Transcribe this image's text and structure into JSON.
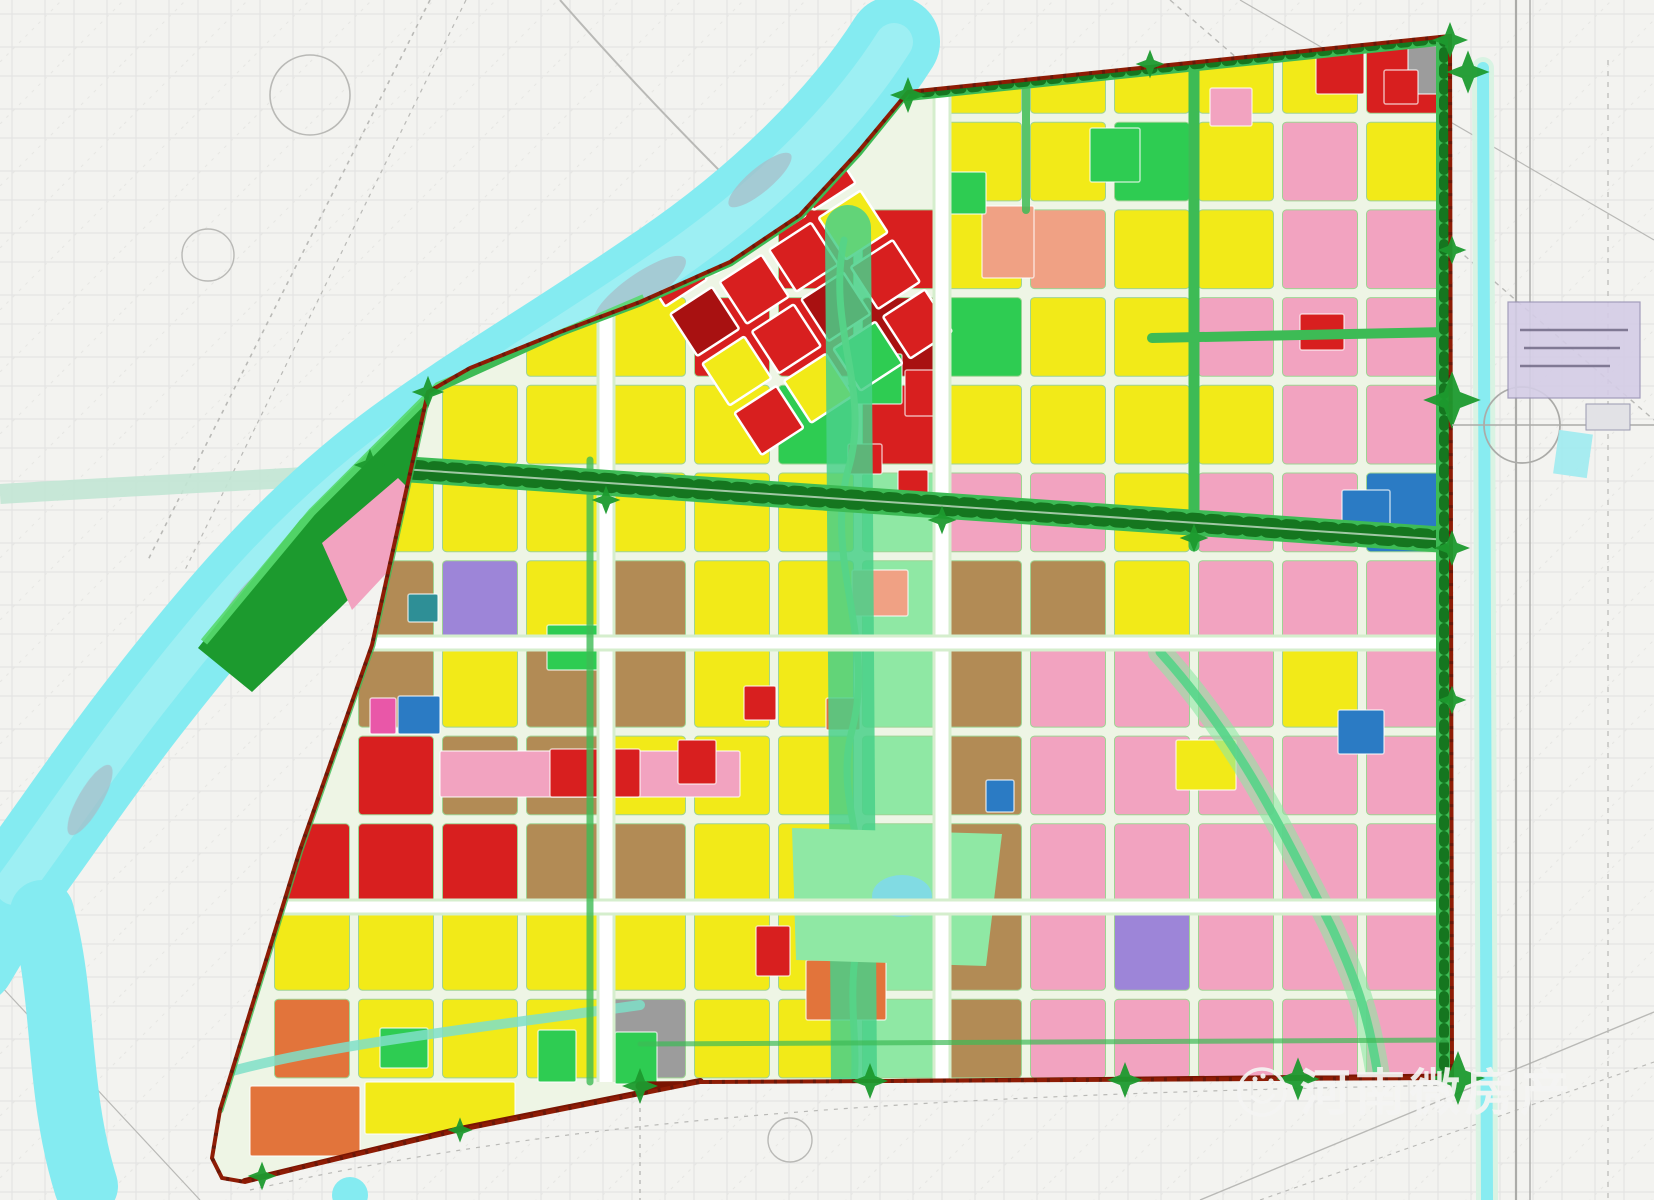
{
  "watermark": {
    "text": "河南微房产",
    "logo": "flower-hand-icon"
  },
  "palette": {
    "Y": "#f2ea18",
    "R": "#d81f1f",
    "C": "#a81111",
    "P": "#f2a3c0",
    "S": "#f0a184",
    "M": "#e957a8",
    "O": "#e2743b",
    "N": "#b28b55",
    "A": "#9c9c9c",
    "B": "#2b7bc4",
    "T": "#2e8f96",
    "U": "#9d85d8",
    "G": "#2ecc52",
    "L": "#8fe8a4",
    "D": "#1c9a2e"
  },
  "features": {
    "paper": "#f3f3f0",
    "sketch_line": "#d9d9d6",
    "river": "#84ebf1",
    "river_highlight": "#b6f4f6",
    "river_island": "#a8bcc8",
    "canal": "#c2e6d4",
    "interior": "#eef5e5",
    "boundary_red": "#8e1c05",
    "bottom_road_red": "#7a1502",
    "corridor_green": "#3dbb55",
    "tree_green": "#15761f",
    "park_light": "#8fe8a4",
    "stream_green": "#55d488",
    "spine_green": "#49d08a",
    "wedge_green": "#1c9a2e",
    "rim_green": "#58d96e",
    "street_edge": "#d5eecd",
    "cell_edge": "#9fd393",
    "highway_gray": "#ababa8",
    "info_box": "#d4cde6",
    "info_box_edge": "#9a93b5",
    "pond_blue": "#7fd9ea",
    "watermark_white": "#f5f5f3"
  },
  "map": {
    "grid": {
      "x0": 270,
      "y0": 30,
      "cols": 14,
      "rows": 12,
      "cw": 84,
      "rh": 87.7,
      "gap": 9
    },
    "rows": [
      "........YYYYYR",
      "........YYGYPY",
      "......RRYSYYPP",
      "...YYRRCGYYPPP",
      "..YYYYGRYYYYPP",
      ".YYYYYYLPPYPPB",
      ".NUYNYYLNNYPPP",
      ".NYNNYYLNPPPYP",
      ".RNNYYYLNPPPPP",
      "RRRNNYYLNPPPPP",
      "YYYYYYYLNPUPPP",
      "OYYYAYYLNPPPPP"
    ],
    "spots": [
      {
        "x": 1316,
        "y": 52,
        "w": 48,
        "h": 42,
        "c": "R"
      },
      {
        "x": 1408,
        "y": 46,
        "w": 40,
        "h": 48,
        "c": "A"
      },
      {
        "x": 1384,
        "y": 70,
        "w": 34,
        "h": 34,
        "c": "R"
      },
      {
        "x": 1090,
        "y": 128,
        "w": 50,
        "h": 54,
        "c": "G"
      },
      {
        "x": 982,
        "y": 206,
        "w": 52,
        "h": 72,
        "c": "S"
      },
      {
        "x": 1300,
        "y": 314,
        "w": 44,
        "h": 36,
        "c": "R"
      },
      {
        "x": 852,
        "y": 354,
        "w": 50,
        "h": 50,
        "c": "G"
      },
      {
        "x": 940,
        "y": 172,
        "w": 46,
        "h": 42,
        "c": "G"
      },
      {
        "x": 848,
        "y": 444,
        "w": 34,
        "h": 30,
        "c": "R"
      },
      {
        "x": 898,
        "y": 470,
        "w": 30,
        "h": 26,
        "c": "R"
      },
      {
        "x": 852,
        "y": 570,
        "w": 56,
        "h": 46,
        "c": "S"
      },
      {
        "x": 547,
        "y": 625,
        "w": 52,
        "h": 45,
        "c": "G"
      },
      {
        "x": 398,
        "y": 696,
        "w": 42,
        "h": 38,
        "c": "B"
      },
      {
        "x": 370,
        "y": 698,
        "w": 26,
        "h": 36,
        "c": "M"
      },
      {
        "x": 408,
        "y": 594,
        "w": 30,
        "h": 28,
        "c": "T"
      },
      {
        "x": 440,
        "y": 751,
        "w": 300,
        "h": 46,
        "c": "P"
      },
      {
        "x": 550,
        "y": 749,
        "w": 90,
        "h": 48,
        "c": "R"
      },
      {
        "x": 678,
        "y": 740,
        "w": 38,
        "h": 44,
        "c": "R"
      },
      {
        "x": 744,
        "y": 686,
        "w": 32,
        "h": 34,
        "c": "R"
      },
      {
        "x": 826,
        "y": 698,
        "w": 34,
        "h": 32,
        "c": "O"
      },
      {
        "x": 986,
        "y": 780,
        "w": 28,
        "h": 32,
        "c": "B"
      },
      {
        "x": 1176,
        "y": 740,
        "w": 60,
        "h": 50,
        "c": "Y"
      },
      {
        "x": 1338,
        "y": 710,
        "w": 46,
        "h": 44,
        "c": "B"
      },
      {
        "x": 1342,
        "y": 490,
        "w": 48,
        "h": 54,
        "c": "B"
      },
      {
        "x": 756,
        "y": 926,
        "w": 34,
        "h": 50,
        "c": "R"
      },
      {
        "x": 806,
        "y": 960,
        "w": 80,
        "h": 60,
        "c": "O"
      },
      {
        "x": 905,
        "y": 370,
        "w": 42,
        "h": 46,
        "c": "R"
      },
      {
        "x": 1210,
        "y": 88,
        "w": 42,
        "h": 38,
        "c": "P"
      },
      {
        "x": 380,
        "y": 1028,
        "w": 48,
        "h": 40,
        "c": "G"
      },
      {
        "x": 538,
        "y": 1030,
        "w": 38,
        "h": 52,
        "c": "G"
      },
      {
        "x": 615,
        "y": 1032,
        "w": 42,
        "h": 52,
        "c": "G"
      },
      {
        "x": 250,
        "y": 1086,
        "w": 110,
        "h": 70,
        "c": "O"
      },
      {
        "x": 365,
        "y": 1082,
        "w": 150,
        "h": 52,
        "c": "Y"
      }
    ],
    "old_town": {
      "cx": 795,
      "cy": 298,
      "angle": -33,
      "cell": 50,
      "gap": 9,
      "rows": [
        "RRYR",
        "CRRY",
        "YRCR",
        "RYGR"
      ]
    },
    "tree_clusters": [
      [
        908,
        95,
        1
      ],
      [
        1150,
        64,
        0.8
      ],
      [
        1450,
        40,
        1
      ],
      [
        1468,
        72,
        1.2
      ],
      [
        1452,
        250,
        0.8
      ],
      [
        1452,
        400,
        1.6
      ],
      [
        1452,
        548,
        1
      ],
      [
        1452,
        700,
        0.8
      ],
      [
        1458,
        1078,
        1.5
      ],
      [
        1298,
        1079,
        1.2
      ],
      [
        1125,
        1080,
        1
      ],
      [
        870,
        1081,
        1
      ],
      [
        640,
        1086,
        1
      ],
      [
        460,
        1130,
        0.7
      ],
      [
        262,
        1176,
        0.8
      ],
      [
        428,
        392,
        0.9
      ],
      [
        370,
        465,
        0.9
      ],
      [
        606,
        500,
        0.8
      ],
      [
        942,
        520,
        0.8
      ],
      [
        1194,
        538,
        0.8
      ]
    ]
  }
}
